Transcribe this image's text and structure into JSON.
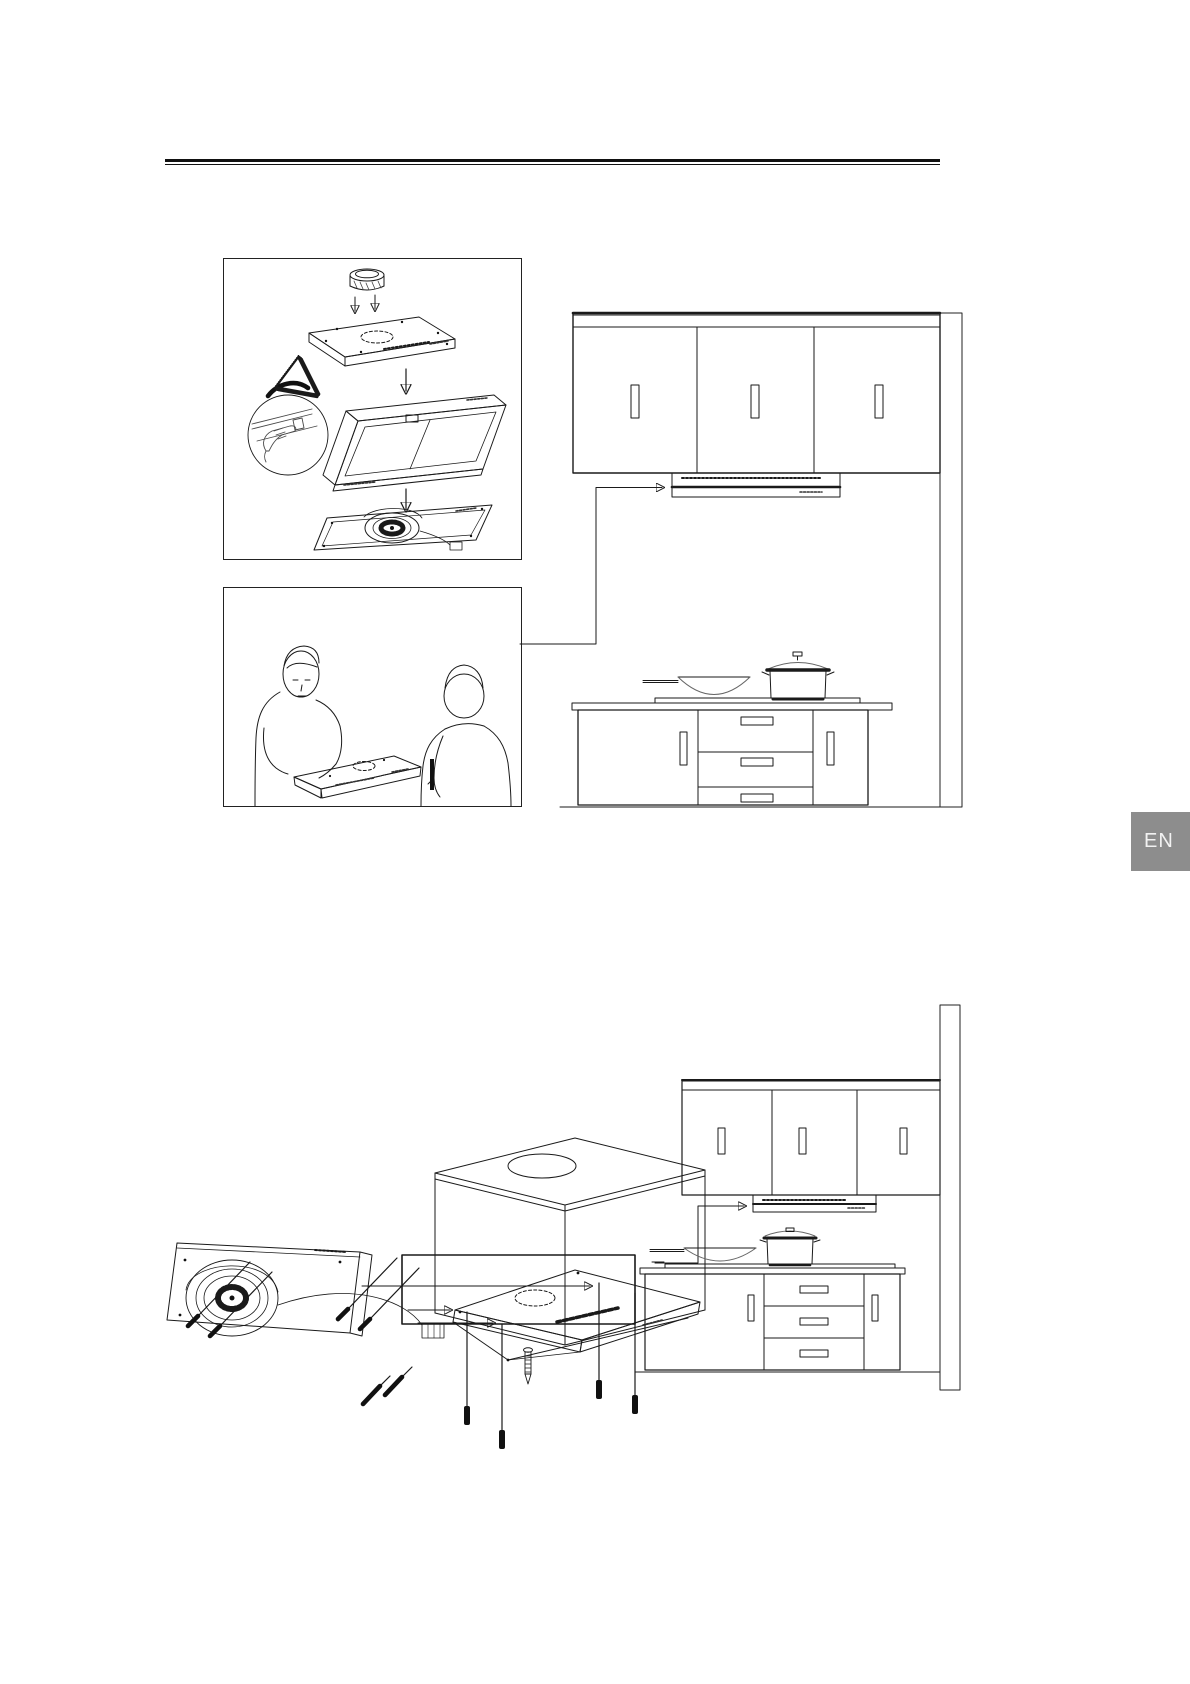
{
  "language_tab": {
    "label": "EN"
  },
  "colors": {
    "background": "#ffffff",
    "line": "#1a1a1a",
    "light_line": "#b3b3b3",
    "tab_bg": "#8d8d8d",
    "tab_text": "#f2f2f2"
  },
  "illustrations": {
    "figure1": "hood-exploded-steps",
    "figure2": "two-person-lift",
    "kitchen_top": "hood-under-cabinet-elevation",
    "figure3": "fan-compartment-with-screws",
    "figure4": "cabinet-cutout-template",
    "kitchen_bottom": "hood-built-in-elevation"
  }
}
